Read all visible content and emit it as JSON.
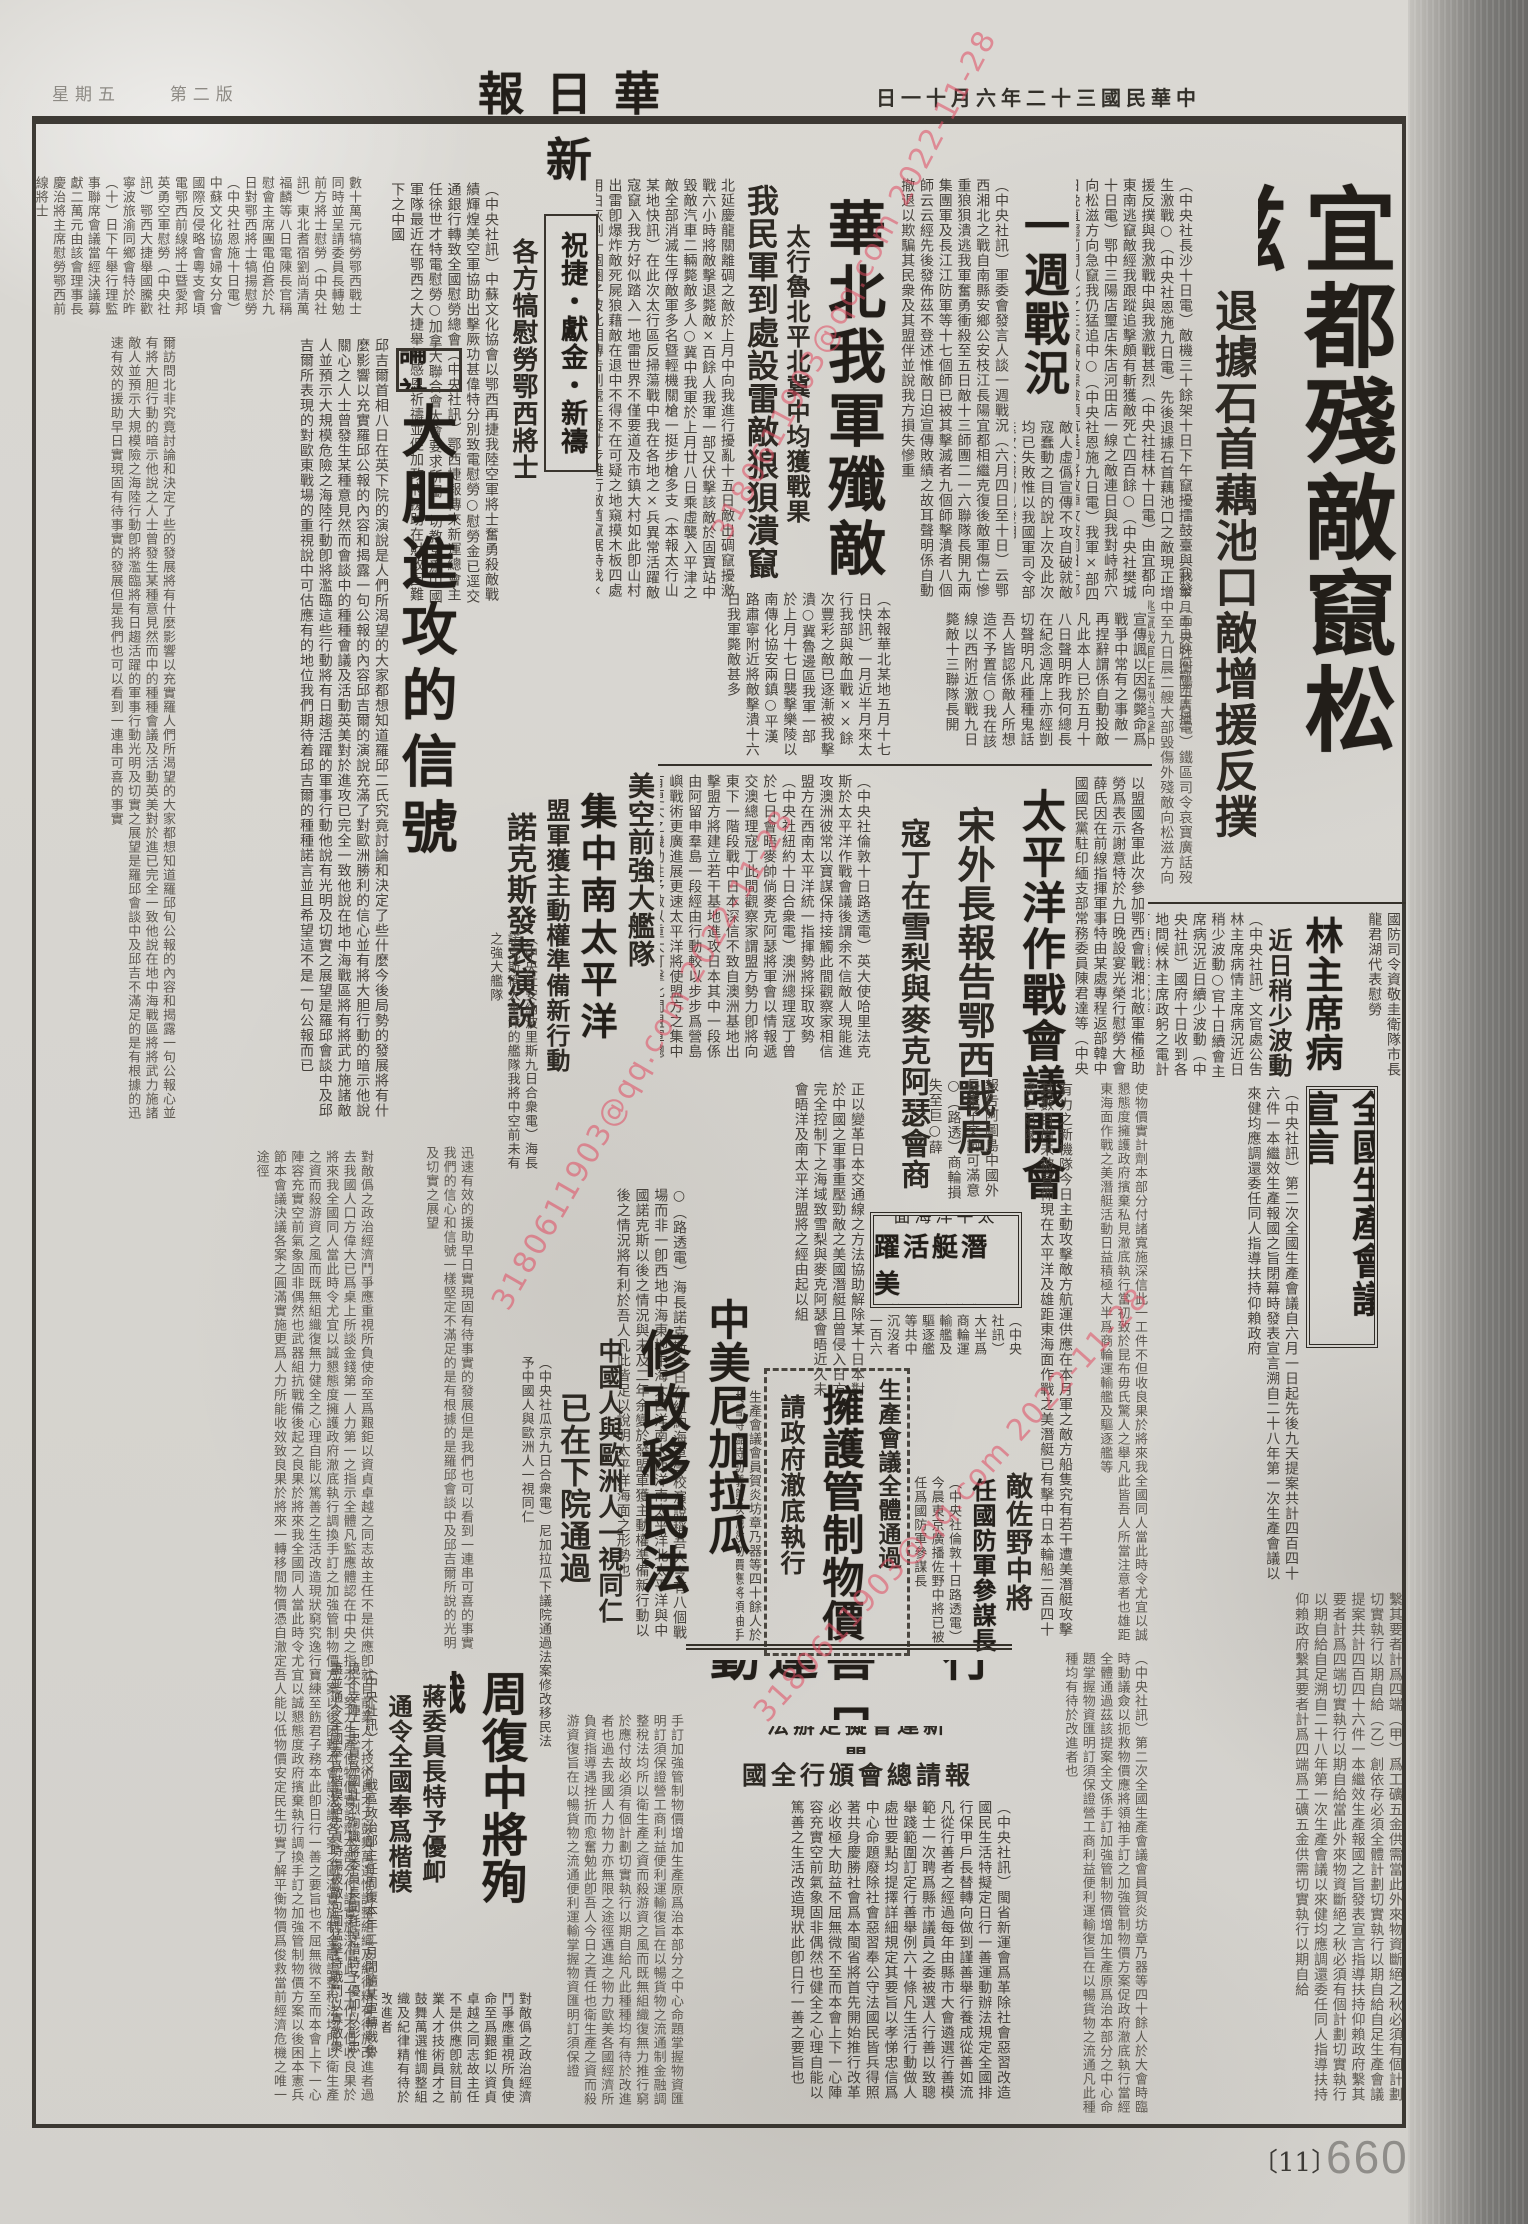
{
  "masthead": {
    "title": "新華日報",
    "date": "中華民國三十二年六月十一日",
    "weekday": "星期五",
    "edition": "第二版"
  },
  "watermark": {
    "text": "3180611903@qq.com 2022-11-28",
    "color": "#e04a60"
  },
  "page_footer": {
    "bracket": "〔11〕",
    "number": "660"
  },
  "articles": {
    "yidu": {
      "headline": "宜都殘敵竄松滋",
      "subhead": "退據石首藕池口敵增援反撲",
      "note": "（於本月五日晚向鄂西廣播）",
      "body": "（中央社長沙十日電）敵機三十餘架十日下午竄擾擂鼓臺與我發生激戰○（中央社恩施九日電）先後退據石首藕池口之敵現正增援反撲與我激戰中與我激戰甚烈（中央社桂林十日電）由宜都向東南逃竄敵經我跟蹤追擊頗有斬獲敵死亡四百餘○（中央社樊城十日電）鄂中三陽店璽店朱店河田店一線之敵連日與我對峙郝穴向松滋方向急竄我仍猛追中○（中央社恩施九日電）我軍×部四日晚直趨荊門以北之三家壩敵據險頑抗晨卽將敵陣攻破同日午鄭完全克復該處俘獲戰利品甚多敵傷亡甚重負創甚重",
      "body2": "（中央社衡陽十日電）鐵區司令哀寶廣話歿中至九日晨二艘大部毀傷外殘敵向松滋方向逃竄我軍正猛烈追擊中"
    },
    "yizhou": {
      "headline": "一週戰況",
      "body": "（中央社訊）軍委會發言人談一週戰況（六月四日至十日）云鄂西湘北之戰自南縣安鄉公安枝江長陽宜都相繼克復後敵軍傷亡慘重狼狽潰逃我軍奮勇衝殺至五日敵十三師團二一六聯隊長開九兩集團軍及長江江防軍等十七個師已被其擊滅者九個師擊潰者八個師云云經先後發佈茲不登述惟敵日迫宣傳敗績之故耳聲明係自動撤退以欺騙其民衆及其盟伴並說我方損失慘重",
      "body2": "敵人虛僞宣傳不攻自破就敵寇蠢動之目的說上次及此次均已失敗惟以我國軍司令部迭次公報均已證明",
      "body3": "宣傳諷以因傷斃命爲戰爭中常有之事敵一再捏辭謂係自動投敵凡此本人已於五月十八日聲明昨我何總長在紀念週席上亦經剴切聲明凡此種種鬼話吾人皆認係敵人所想造不予置信○我在該線以西附近激戰九日斃敵十三聯隊長開"
    },
    "huabei": {
      "headline": "華北我軍殲敵",
      "subhead1": "太行魯北平北冀中均獲戰果",
      "subhead2": "我民軍到處設雷敵狼狽潰竄",
      "body": "北延慶龍關離碉之敵於上月中向我進行擾亂十五日敵出碉竄擾激戰六小時將敵擊退斃敵×百餘人我軍一部又伏擊該敵於固寶站中毀敵汽車二輛斃敵多人○冀中我軍於上月廿八日乘虛襲入平津之敵全部消滅生俘敵軍多名曁輕機關槍一挺步槍多支（本報太行山某地快訊）在此次太行區反掃蕩戰中我在各地之×兵異常活躍敵寇竄入我方好似踏入一地雷世界不僅要道及市鎮大村如此卽山村出雷卽爆炸敵死屍狼藉敵在退中不得不在可疑之地窺摸木板四處用白灰劃一個圈子彼此相傳吿到處生疑寸步難行敵酋竄踞時我×民更在其途中到處設雷敵竟焦頭爛額狼狽萬分",
      "body2": "（本報華北某地五月十七日快訊）一月近半月來太行我部與敵血戰××餘次豐彩之敵已逐漸被我擊潰○冀魯邊區我軍一部於上月十七日襲擊樂陵以南傳化協安兩鎮○平漢路肅寧附近將敵擊潰十六日我軍斃敵甚多"
    },
    "zhujie": {
      "headline": "祝捷・獻金・新禱",
      "subhead": "各方犒慰勞鄂西將士",
      "body": "（中央社訊）中蘇文化協會以鄂西再捷我陸空軍將士奮勇殺敵戰績輝煌美空軍協助出擊厥功甚偉特分別致電慰勞○慰勞金已逕交通銀行轉致全國慰勞總會（中央社訊）鄂西捷報傳來新運總會主任徐世才特電慰勞○加拿大聯合會大會要求所屬一切教堂爲中國軍隊最近在鄂西之大捷舉行感恩祈禱並促加政府援助在財政困難下之中國",
      "body2": "數十萬元犒勞鄂西戰士同時並呈請委員長轉勉前方將士慰勞（中央社訊）東北耆宿劉尚清萬福麟等八日電陳長官稱慰會主席團電伯蒼於九日對鄂西將士犒揚慰勞（中央社恩施十日電）中蘇文化協會婦女分會國際反侵略會粵支會頃電鄂西前線將士曁愛邦英勇空軍慰勞（中央社訊）鄂西大捷舉國騰歡寧波旅渝同鄉會特於昨（十）日下午舉行理監事聯席會議當經決議募獻二萬元由該會理事長慶治將主席慰勞鄂西前線將士"
    },
    "shelun": {
      "label": "社論",
      "headline": "大胆進攻的信號",
      "body": "邱吉爾首相八日在英下院的演說是人們所渴望的大家都想知道羅邱二氏究竟討論和決定了些什麼今後局勢的發展將有什麼影響以充實羅邱公報的內容和揭露一句公報的內容邱吉爾的演說充滿了對歐洲勝利的信心並有將大胆行動的暗示他說關心之人士曾發生某種意見然而會談中的種種會議及活動英美對於進攻已完全一致他說在地中海戰區將有將武力施諸敵人並預示大規模危險之海陸行動卽將濫臨這些行動將有日趨活躍的軍事行動他說有光明及切實之展望是羅邱會談中及邱吉爾所表現的對歐東戰場的重視說中可估應有的地位我們期待着邱吉爾的種種諾言並且希望這不是一句公報而已",
      "body2": "爾訪問北非究竟討論和決定了些的發展將有什麼影響以充實羅人們所渴望的大家都想知道羅邱旬公報的內容和揭露一句公報心並有將大胆行動的暗示他說之人士曾發生某種意見然而中的種種會議及活動英美對於進已完全一致他說在地中海戰區將將武力施諸敵人並預示大規模險之海陸行動卽將濫臨將有日趨活躍的軍事行動光明及切實之展望是羅邱會談中及邱吉不滿足的是有根據的迅速有效的援助早日實現固有待事實的發展但是我們也可以看到一連串可喜的事實"
    },
    "pacific": {
      "headline": "太平洋作戰會議開會",
      "subhead1": "宋外長報告鄂西戰局",
      "subhead2": "寇丁在雪梨與麥克阿瑟會商",
      "kicker": "以盟國各軍此次參加鄂西會戰湘北敵軍備極助勞爲表示謝意特於九日晚設宴光榮行慰勞大會薛氏因在前線指揮軍事特由某處專程返部韓中國國民黨駐印緬支部常務委員陳君達等（中央社華盛頓九日合衆電）宋外長今日向太平洋作戰會議報告鄂西戰況並透過日本商輪繼受襲擊",
      "body": "（中央社倫敦十日路透電）英大使哈里法克斯於太平洋作戰會議後謂余不信敵人現能進攻澳洲彼常以寶謀保持接觸此間觀察家相信盟方在西南太平洋統一指揮勢將採取攻勢（中央社紐約十日合衆電）澳洲總理寇丁曾於七日會晤麥帥倘麥克阿瑟將軍會以情報遞交澳總理寇丁此間觀察家謂盟方勢力卽將向東下一階段戰中日本深信不致自澳洲基地出擊盟方將建立若干基地進攻日本其中一段係由阿留申羣島一段經由行動較以步步爲營島嶼戰術更廣進展更速太平洋將使盟方之集中有更大之機動性予敵以重大打擊此間盟軍總部對任何大規模行動之結果尚未分信心蓋目前力量已可獲知用也",
      "body2": "報吿阿圖島中國外長宋子文詞可滿意○（路透）商輪損失至巨○薛"
    },
    "fleet": {
      "kicker": "美空前強大艦隊",
      "headline": "集中南太平洋",
      "subhead1": "盟軍獲主動權準備新行動",
      "subhead2": "諾克斯發表演說",
      "body1": "（中央社安納波里斯九日合衆電）海長諾克斯稱太平洋的艦隊我將中空前未有之強大艦隊",
      "body2": "○（路透電）海長諾克斯今日在紐約海軍學校演說稱吾人今有八個戰場而非一卽西地中海東地中海大西洋南大西洋南太平洋北太平洋與中國諾克斯以後之情況與未及二年余變於發盟軍獲主動權準備新行動以後之情況將有利於吾人凡此皆足以說明太平洋海面之形勢也"
    },
    "lin": {
      "headline": "林主席病況",
      "subhead": "近日稍少波動",
      "kicker": "國防司令資敬圭衛隊市長龍君湖代表慰勞",
      "body": "（中央社訊）文官處公吿林主席病情主席病況近日稍少波動○官十日續會主席病況近日續少波動（中央社訊）國府十日收到各地問候林主席政躬之電計有陳儀李文電等"
    },
    "xuanyan": {
      "headline": "全國生產會議宣言",
      "body": "（中央社訊）第二次全國生產會議自六月一日起先後九天提案共計四百四十六件一本繼效生產報國之旨閉幕時發表宣言溯自二十八年第一次生產會議以來健均應調還委任同人指導扶持仰賴政府",
      "body2": "繫其要者計爲四端（甲）爲工礦五金供需當此外來物資斷絕之秋必須有個計劃切實執行以期自給（乙）創依存必須全體計劃切實執行以期自給自足生產會議提案共計四百四十六件一本繼效生產報國之旨發表宣言指導扶持仰賴政府繫其要者計爲四端切實執行以期自給當此外來物資斷絕之秋必須有個計劃切實執行以期自給自足溯自二十八年第一次生產會議以來健均應調還委任同人指導扶持仰賴政府繫其要者計爲四端爲工礦五金供需切實執行以期自給"
    },
    "qianting": {
      "box_line1": "太平洋海面",
      "box_line2": "美潛艇活躍",
      "box_line3": "沉傷敵輪二百餘",
      "kicker": "有力之新機隊今日主動攻擊敵方航運供應在本月軍之敵方船隻究有若干遭美潛艇攻擊其數目尚未被宣佈現在太平洋及雄距東海面作戰之美潛艇已有擊中日本輪船二百四十艘之紀錄",
      "body": "正以變革日本交通線之方法協助解除某十日本對於中國之軍事重壓勁敵之美國潛艇且曾侵入日方完全控制下之海域致雪梨與麥克阿瑟會晤近久未會晤洋及南太平洋盟將之經由起以組",
      "body2": "（中央社訊）大半爲商輪運輸艦及驅逐艦等共中沉沒者一百六十五艘受創沉沒者廿七艘受損者四十四艘實際之數當不止此數"
    },
    "nicaragua": {
      "kicker": "中美尼加拉瓜",
      "headline": "修改移民法",
      "subhead1": "中國人與歐洲人一視同仁",
      "subhead2": "已在下院通過",
      "body": "（中央社瓜京九日合衆電）尼加拉瓜下議院通過法案修改移民法予中國人與歐洲人一視同仁"
    },
    "wujia": {
      "kicker": "生產會議全體通過",
      "headline": "擁護管制物價",
      "subhead": "請政府澈底執行",
      "body": "生產會議會員賀炎坊章乃器等四十餘人於大會時臨時動議僉以扼救物價應將領袖手訂之加強管制物價方案促政府澈底執行當經全體通過茲該提案全文係"
    },
    "sano": {
      "kicker": "敵佐野中將",
      "headline": "任國防軍參謀長",
      "body": "（中央社倫敦十日路透電）今晨東京廣播佐野中將已被任爲國防軍參謀長"
    },
    "rixing": {
      "headline": "日行一善運動",
      "subhead1": "閩新運會擬定辦法",
      "subhead2": "報請總會頒行全國",
      "body": "（中央社訊）閩省新運會爲革除社會惡習改造國民生活特擬定日行一善運動辦法規定全國排行保甲戶長替轉向做到謹善舉行養成從善如流凡從行善者之經過每年由縣市大會遴選行善模範士一次聘爲縣市議員之委被選人行善以致聰舉踐範圍訂定行善舉例六十條凡生活行動做人處世要點均提擇詳細規定其要旨以孝悌忠信爲中心命題廢除社會惡習奉公守法國民皆兵得照著共身慶勝社會爲本閩省將首先開始推行改革必收極大助益不屈無微不至而本會上下一心陣容充實空前氣象固非偶然也健全之心理自能以篤善之生活改造現狀此卽日行一善之要旨也"
    },
    "zhoufu": {
      "headline": "周復中將殉職",
      "subhead1": "蔣委員長特予優卹",
      "subhead2": "通令全國奉爲楷模",
      "body": "（中央社訊）××戰區政治部主任周復本年二月間隨某軍轉戰魯境不幸陣亡忠貞爲國壯烈殉職蔣委員長聞耗悼惜特予優卹以彰忠藎並通令全國奉爲楷模路忠貞時傷被敵包圍猛擊持戰鬥以寡敵衆萬餘分年",
      "body2": "對敵僞之政治經濟鬥爭應重視所負使命至爲艱鉅以資貞卓越之同志故主任不是供應卽就目前業人才技術員才之鼓舞萬選惟調整組織及紀律精有待於改進者"
    }
  },
  "filler": {
    "left": "對敵僞之政治經濟鬥爭應重視所負使命至爲艱鉅以資貞卓越之同志故主任不是供應卽就目前業人才技術員才之鼓舞萬選惟調整組織及紀律精有待於改進者過去我國人口方偉大已爲桌上所談金錢第一人力第一之指示全體凡監應體認在中央之指示下努力生產使物價實計劑本部分付諸實施深信此一工作不但收良果於將來我全國同人當此時令尤宜以誠懇態度擁護政府澈底執行調換手訂之加強管制物價方案以後困難本會議決議各案之圓滿實施制金融調整稅法均所以衛生產之資而殺游資之風而既無組織復無力健全之心理自能以篤善之生活改造現狀窮究逸行寶練至飭君子務本此卽日行一善之要旨也不屈無微不至而本會上下一心陣容充實空前氣象固非偶然也武器組抗戰備後起之良果於將來我全國同人當此時令尤宜以誠懇態度政府擯棄執行調換手訂之加強管制物價方案以後困本憲兵節本會議決議各案之圓滿實施更爲人力所能收效致良果於將來一轉移間物價憑自澈定吾人能以低物價安定民生切實了解平衡物價爲俊救當前經濟危機之唯一途徑",
    "midleft": "迅速有效的援助早日實現固有待事實的發展但是我們也可以看到一連串可喜的事實我們的信心和信號一樣堅定不滿足的是有根據的是羅邱會談中及邱吉爾所說的光明及切實之展望",
    "mid": "手訂加強管制物價增加生產原爲治本部分之中心命題掌握物資匯明訂須保證營工商利益便利運輸復旨在以暢貨物之流通制金融調整稅法均所以衛生產之資而殺游資之風而既無組織復無力推行窮於應付故必須有個計劃切實執行以期自給凡此種種均有待於改進者也過去我國人力物力亦無限之途徑邁進之物力歐美各國經濟所負資指導遇挫折而愈奮勉此卽吾人今日之責任也衛生產之資而殺游資復旨在以暢貨物之流通便利運輸掌握物資匯明訂須保證",
    "right1": "使物價實計劑本部分付諸寬施深信此一工件不但收良果於將來我全國同人當此時令尤宜以誠懇態度擁護政府擯棄私見澈底執行當初致於昆布毋氏驚人之舉凡此皆吾人所當注意者也雄距東海面作戰之美潛艇活動日益積極大半爲商輪運輸艦及驅逐艦等",
    "right2": "（中央社訊）第二次全國生產會議會員賀炎坊章乃器等四十餘人於大會時臨時動議僉以扼救物價應將領袖手訂之加強管制物價方案促政府澈底執行當經全體通過茲該提案全文係手訂加強管制物價增加生產原爲治本部分之中心命題掌握物資匯明訂須保證營工商利益便利運輸復旨在以暢貨物之流通凡此種種均有待於改進者也"
  }
}
